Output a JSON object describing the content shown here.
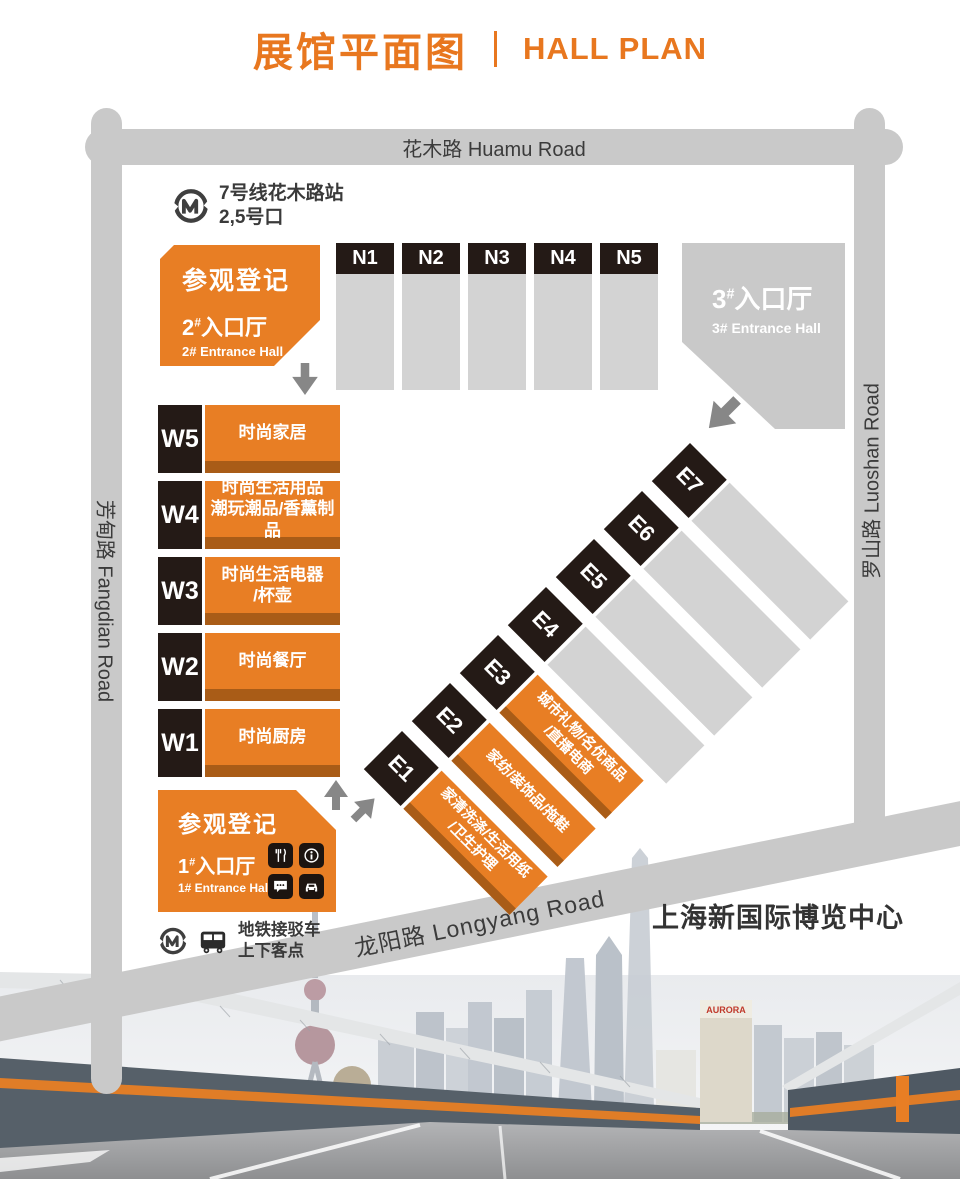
{
  "header": {
    "title_zh": "展馆平面图",
    "title_en": "HALL PLAN"
  },
  "roads": {
    "top": "花木路 Huamu Road",
    "left": "芳甸路 Fangdian Road",
    "right": "罗山路 Luoshan Road",
    "bottom": "龙阳路 Longyang Road"
  },
  "metro_station": {
    "line1": "7号线花木路站",
    "line2": "2,5号口"
  },
  "shuttle": {
    "line1": "地铁接驳车",
    "line2": "上下客点"
  },
  "entrances": {
    "e1": {
      "register": "参观登记",
      "num": "1",
      "sup": "#",
      "hall_zh": "入口厅",
      "hall_en": "1# Entrance Hall"
    },
    "e2": {
      "register": "参观登记",
      "num": "2",
      "sup": "#",
      "hall_zh": "入口厅",
      "hall_en": "2# Entrance Hall"
    },
    "e3": {
      "num": "3",
      "sup": "#",
      "hall_zh": "入口厅",
      "hall_en": "3# Entrance Hall"
    }
  },
  "north_halls": [
    {
      "id": "N1"
    },
    {
      "id": "N2"
    },
    {
      "id": "N3"
    },
    {
      "id": "N4"
    },
    {
      "id": "N5"
    }
  ],
  "west_halls": [
    {
      "id": "W5",
      "lines": [
        "时尚家居"
      ]
    },
    {
      "id": "W4",
      "lines": [
        "时尚生活用品",
        "潮玩潮品/香薰制品"
      ]
    },
    {
      "id": "W3",
      "lines": [
        "时尚生活电器",
        "/杯壶"
      ]
    },
    {
      "id": "W2",
      "lines": [
        "时尚餐厅"
      ]
    },
    {
      "id": "W1",
      "lines": [
        "时尚厨房"
      ]
    }
  ],
  "east_halls": [
    {
      "id": "E1",
      "lines": [
        "家清洗涤/生活用纸",
        "/卫生护理"
      ]
    },
    {
      "id": "E2",
      "lines": [
        "家纺/装饰品/拖鞋"
      ]
    },
    {
      "id": "E3",
      "lines": [
        "城市礼物/名优商品",
        "/直播电商"
      ]
    },
    {
      "id": "E4",
      "lines": []
    },
    {
      "id": "E5",
      "lines": []
    },
    {
      "id": "E6",
      "lines": []
    },
    {
      "id": "E7",
      "lines": []
    }
  ],
  "venue_name": "上海新国际博览中心",
  "photo": {
    "aurora_sign": "AURORA"
  },
  "icons": {
    "metro": "shanghai-metro-logo-icon",
    "bus": "bus-icon",
    "entrance1_services": [
      "restaurant-icon",
      "info-icon",
      "chat-icon",
      "taxi-icon"
    ],
    "arrows": [
      "arrow-down-icon",
      "arrow-southwest-icon",
      "arrow-up-icon",
      "arrow-northeast-icon"
    ]
  },
  "colors": {
    "accent_orange": "#e87e24",
    "dark_orange": "#a95c17",
    "label_dark": "#241a16",
    "hall_gray": "#d3d3d3",
    "road_gray": "#c9c9c9"
  }
}
